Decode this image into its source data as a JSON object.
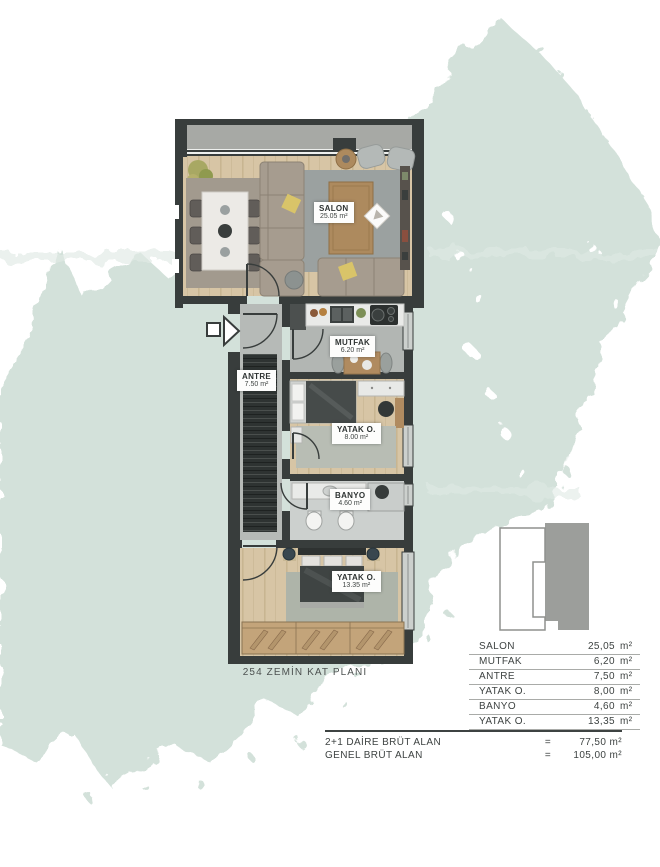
{
  "floorplan": {
    "caption": "254 ZEMİN KAT PLANI",
    "rooms": [
      {
        "id": "salon",
        "name": "SALON",
        "area": "25.05 m²"
      },
      {
        "id": "mutfak",
        "name": "MUTFAK",
        "area": "6.20 m²"
      },
      {
        "id": "antre",
        "name": "ANTRE",
        "area": "7.50 m²"
      },
      {
        "id": "yatak1",
        "name": "YATAK O.",
        "area": "8.00 m²"
      },
      {
        "id": "banyo",
        "name": "BANYO",
        "area": "4.60 m²"
      },
      {
        "id": "yatak2",
        "name": "YATAK O.",
        "area": "13.35 m²"
      }
    ]
  },
  "area_table": {
    "rows": [
      {
        "label": "SALON",
        "value": "25,05",
        "unit": "m²"
      },
      {
        "label": "MUTFAK",
        "value": "6,20",
        "unit": "m²"
      },
      {
        "label": "ANTRE",
        "value": "7,50",
        "unit": "m²"
      },
      {
        "label": "YATAK O.",
        "value": "8,00",
        "unit": "m²"
      },
      {
        "label": "BANYO",
        "value": "4,60",
        "unit": "m²"
      },
      {
        "label": "YATAK O.",
        "value": "13,35",
        "unit": "m²"
      }
    ],
    "summary": [
      {
        "label": "2+1 DAİRE BRÜT ALAN",
        "equals": "=",
        "value": "77,50 m²"
      },
      {
        "label": "GENEL BRÜT ALAN",
        "equals": "=",
        "value": "105,00 m²"
      }
    ]
  },
  "colors": {
    "watercolor": "#d3e1da",
    "watercolor_light": "#e0eae5",
    "wall": "#383d3c",
    "wood_floor": "#d7c5a5",
    "accent_pillow": "#d9c469",
    "keyplan_gray": "#9c9e9b"
  }
}
